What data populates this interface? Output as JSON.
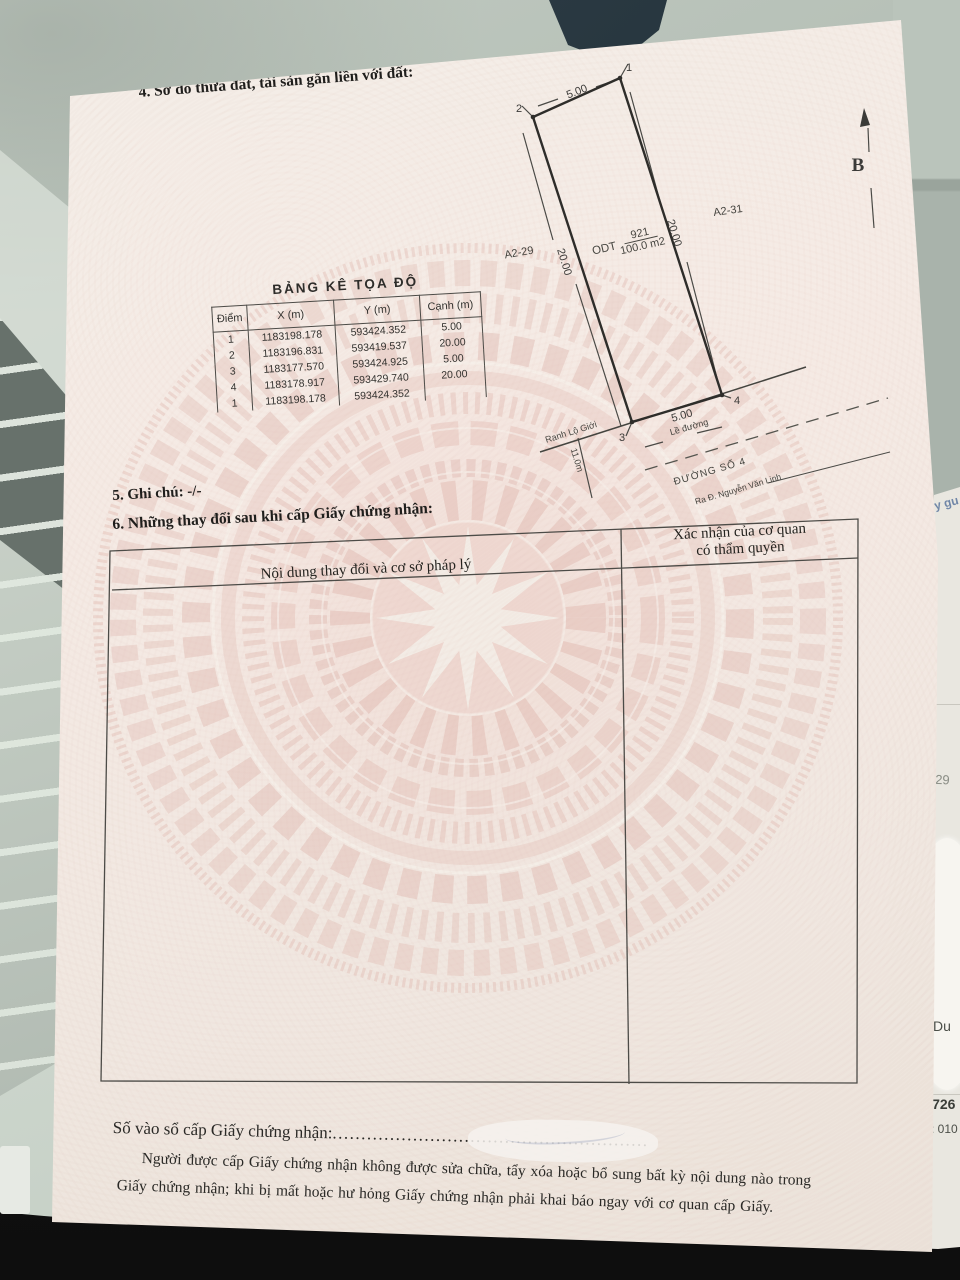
{
  "doc": {
    "section4_title": "4. Sơ đồ thửa đất, tài sản gắn liền với đất:",
    "diagram": {
      "north_symbol": "B",
      "corners": [
        "1",
        "2",
        "3",
        "4"
      ],
      "dim_top": "5.00",
      "dim_right": "20.00",
      "dim_left": "20.00",
      "dim_bottom": "5.00",
      "parcel_code": "ODT",
      "parcel_number": "921",
      "parcel_area": "100.0 m2",
      "neighbor_left": "A2-29",
      "neighbor_right": "A2-31",
      "boundary_label": "Ranh Lộ Giới",
      "curb_label": "Lề đường",
      "setback": "11.0m",
      "road_name": "ĐƯỜNG SỐ  4",
      "road_note": "Ra Đ. Nguyễn Văn Linh"
    },
    "coord_table": {
      "title": "BẢNG KÊ TỌA ĐỘ",
      "headers": [
        "Điểm",
        "X (m)",
        "Y (m)",
        "Cạnh (m)"
      ],
      "rows": [
        [
          "1",
          "1183198.178",
          "593424.352",
          "5.00"
        ],
        [
          "2",
          "1183196.831",
          "593419.537",
          "20.00"
        ],
        [
          "3",
          "1183177.570",
          "593424.925",
          "5.00"
        ],
        [
          "4",
          "1183178.917",
          "593429.740",
          "20.00"
        ],
        [
          "1",
          "1183198.178",
          "593424.352",
          ""
        ]
      ]
    },
    "section5": "5. Ghi chú: -/-",
    "section6_title": "6. Những thay đổi sau khi cấp Giấy chứng nhận:",
    "change_table": {
      "col1": "Nội dung thay đổi và cơ sở pháp lý",
      "col2_line1": "Xác nhận của cơ quan",
      "col2_line2": "có thẩm quyền"
    },
    "registry": {
      "label": "Số vào sổ cấp Giấy chứng nhận:",
      "dots": "......................................................."
    },
    "footer_line1": "Người được cấp Giấy chứng nhận không được sửa chữa, tẩy xóa hoặc bổ sung bất kỳ nội dung nào trong",
    "footer_line2": "Giấy chứng nhận; khi bị mất hoặc hư hỏng Giấy chứng nhận phải khai báo ngay với cơ quan cấp Giấy."
  },
  "background": {
    "frag_top": "y gu",
    "frag_num": "929",
    "frag_du": "Du",
    "frag_code": "D726",
    "frag_tel": "T: 010"
  }
}
